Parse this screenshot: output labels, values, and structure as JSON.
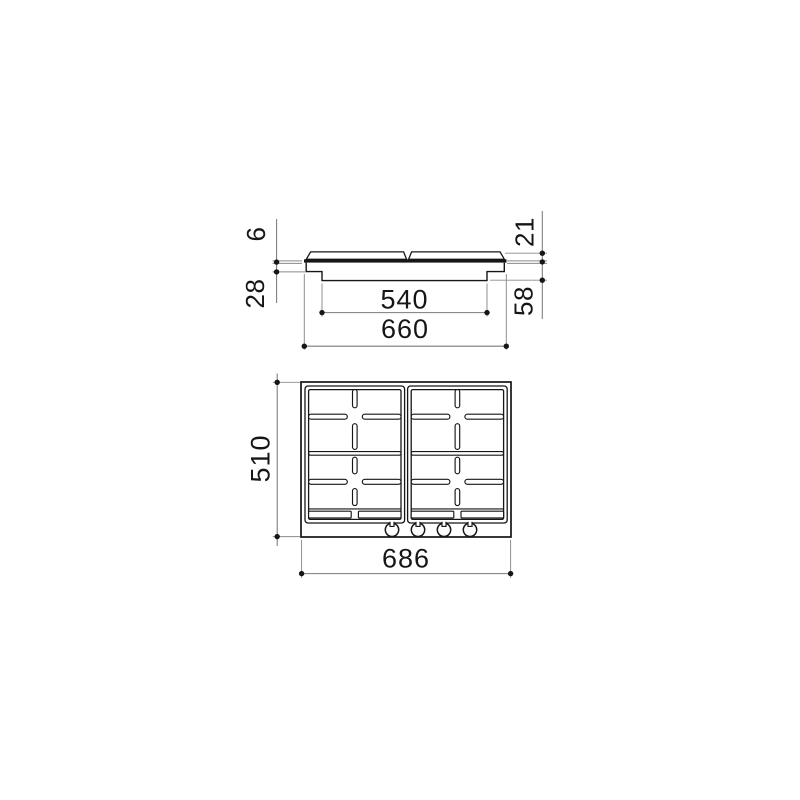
{
  "drawing": {
    "subject": "built-in 4-burner gas hob dimension drawing",
    "views": {
      "front_view_present": true,
      "top_view_present": true
    },
    "knobs": {
      "count": 4
    }
  },
  "colors": {
    "object_line": "#161616",
    "dimension_line": "#7a7a7a",
    "background": "#ffffff"
  },
  "dims": {
    "plate_thickness": "6",
    "grid_height": "21",
    "flange_depth": "28",
    "body_depth": "58",
    "recess_width": "540",
    "plate_width": "660",
    "overall_depth": "510",
    "overall_width": "686"
  }
}
